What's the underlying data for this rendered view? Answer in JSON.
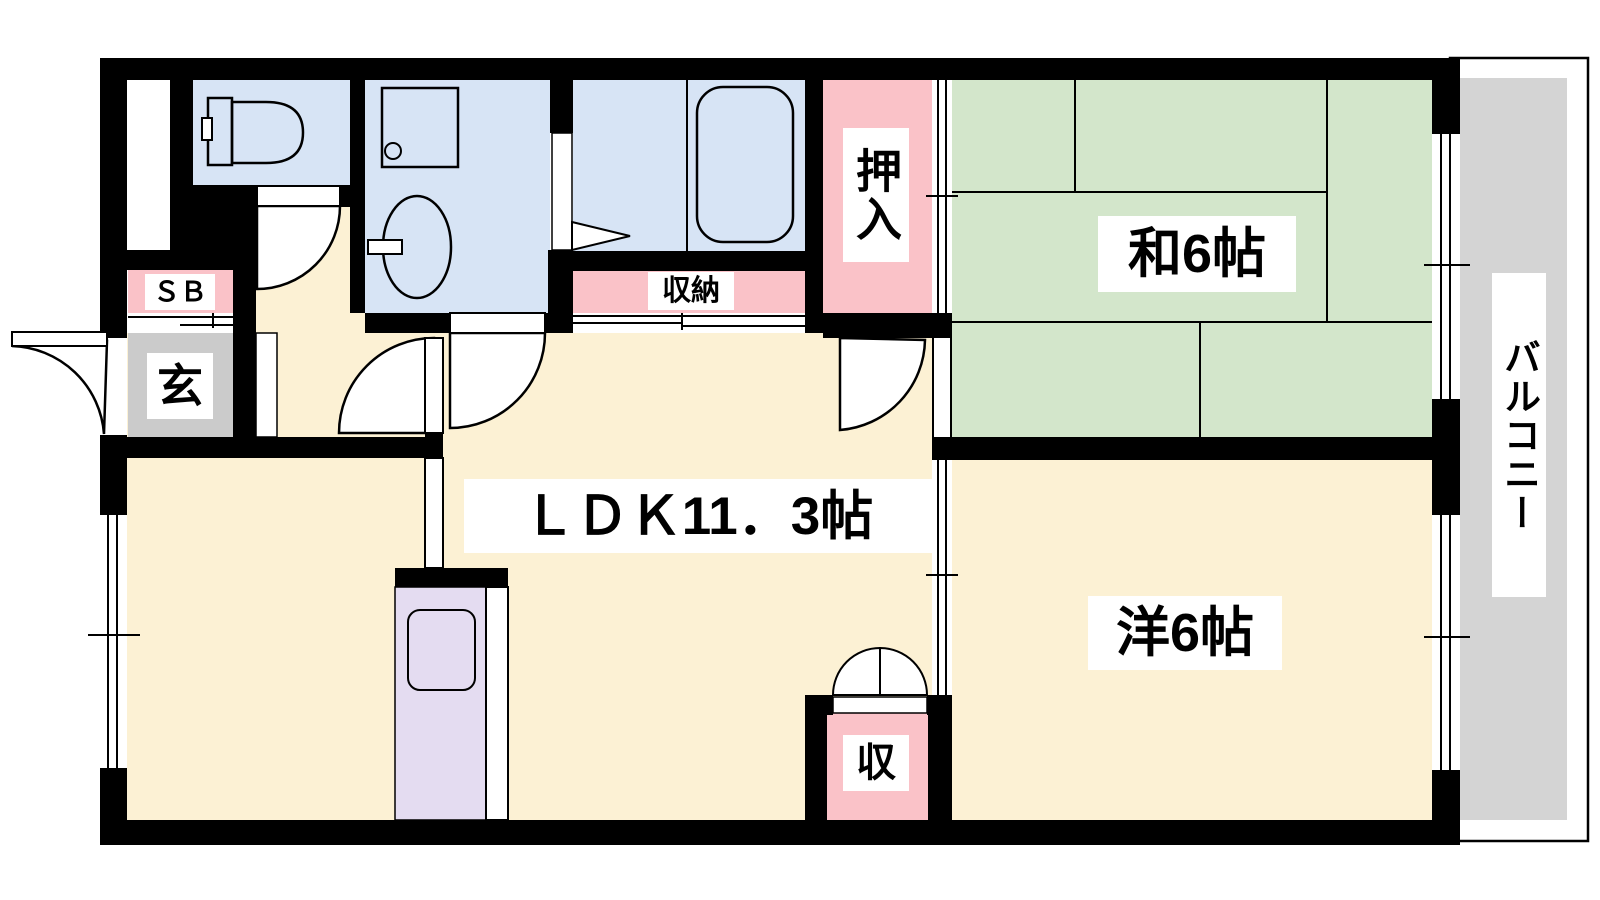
{
  "title": "apartment-floor-plan",
  "labels": {
    "ldk": "ＬＤＫ11．3帖",
    "washitsu": "和6帖",
    "youshitsu": "洋6帖",
    "oshiire": "押入",
    "shuunou": "収納",
    "shuu": "収",
    "genkan": "玄",
    "shoe_box": "ＳＢ",
    "balcony": "バルコニー"
  },
  "colors": {
    "room_floor": "#FCF1D4",
    "tatami": "#D3E6CB",
    "wet_area": "#D7E4F5",
    "closet": "#FAC2C8",
    "entrance_floor": "#CBCBCB",
    "balcony_floor": "#D4D4D4",
    "kitchen_unit": "#E4DCF1",
    "wall": "#000000"
  }
}
